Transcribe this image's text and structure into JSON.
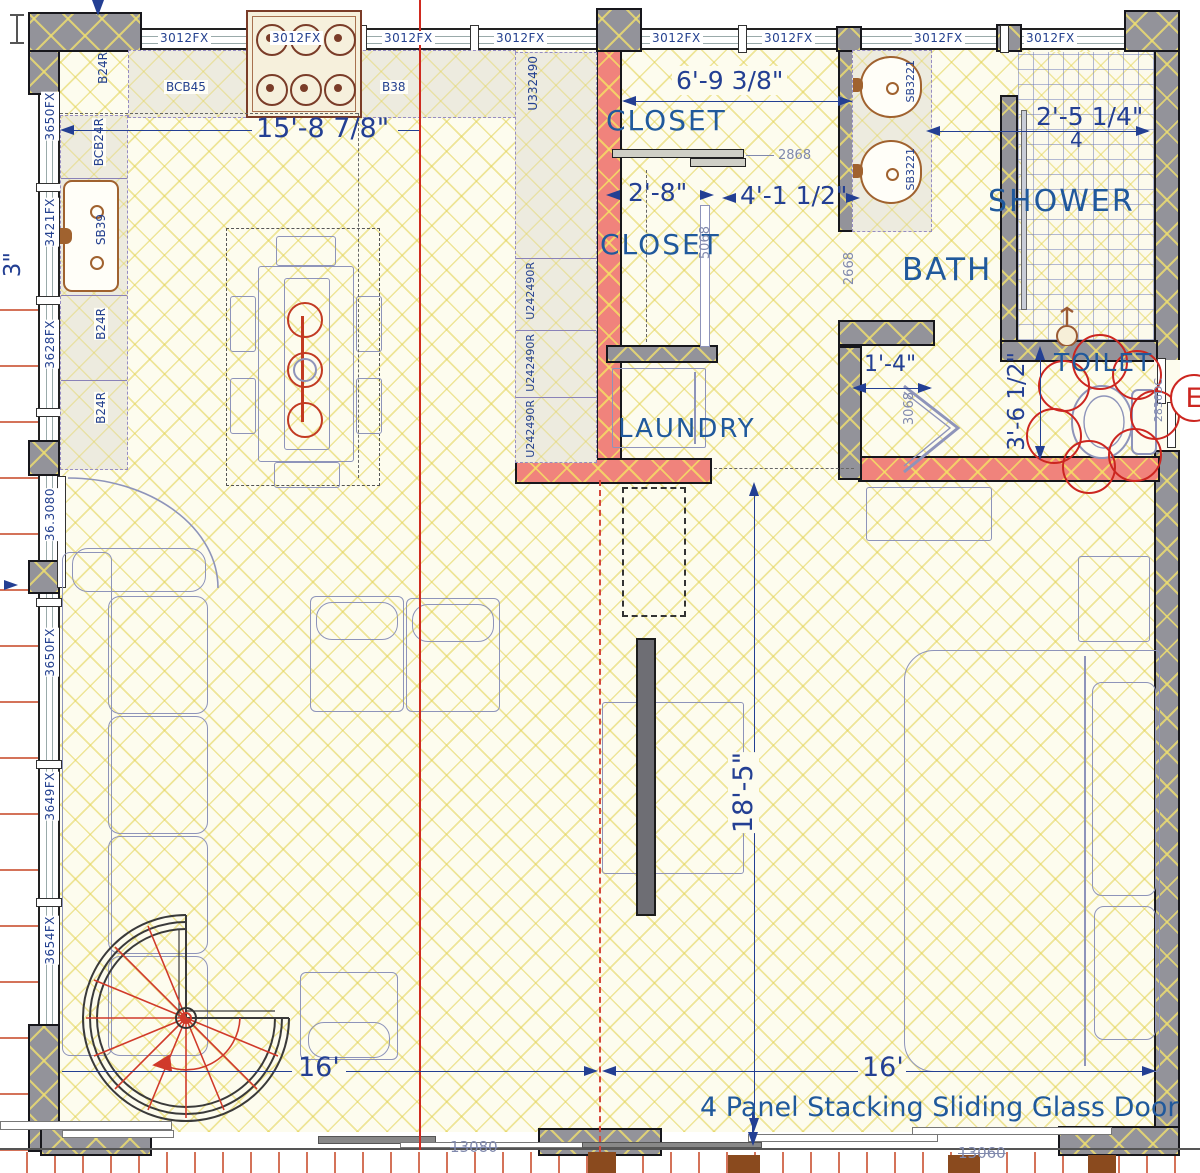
{
  "windows": {
    "top": [
      "3012FX",
      "3012FX",
      "3012FX",
      "3012FX",
      "3012FX",
      "3012FX",
      "3012FX",
      "3012FX"
    ],
    "left": [
      "3650FX",
      "3421FX",
      "3628FX",
      "3650FX",
      "3649FX",
      "3654FX"
    ],
    "left_door_label": "36.3080"
  },
  "cabinets": {
    "corner": "B24R",
    "range_wall": [
      "BCB45",
      "B38"
    ],
    "sink_wall": [
      "BCB24R",
      "SB39",
      "B24R",
      "B24R"
    ],
    "tall": [
      "U332490",
      "U242490R",
      "U242490R",
      "U242490R"
    ],
    "vanity": [
      "SB3221",
      "SB3221"
    ]
  },
  "rooms": {
    "closet_upper": "CLOSET",
    "closet_lower": "CLOSET",
    "laundry": "LAUNDRY",
    "bath": "BATH",
    "shower": "SHOWER",
    "toilet": "TOILET"
  },
  "dims": {
    "kitchen": "15'-8 7/8\"",
    "closet_w": "6'-9 3/8\"",
    "shower_w": "2'-5 1/4\"",
    "shower_w2": "4",
    "closet_d1": "2'-8\"",
    "closet_d2": "4'-1 1/2\"",
    "toilet_wall": "1'-4\"",
    "toilet_d": "3'-6 1/2\"",
    "living": "18'-5\"",
    "left16": "16'",
    "right16": "16'",
    "left_edge_partial": "3\""
  },
  "doors": {
    "bypass": "2868",
    "bath_entry": "2668",
    "closet_slider": "5068",
    "bifold": "3068",
    "toilet_door": "2836DC",
    "glass_left": "13080",
    "glass_right": "13060"
  },
  "notes": {
    "glass_door": "4 Panel Stacking Sliding Glass Door"
  },
  "markers": {
    "revision": "E"
  }
}
